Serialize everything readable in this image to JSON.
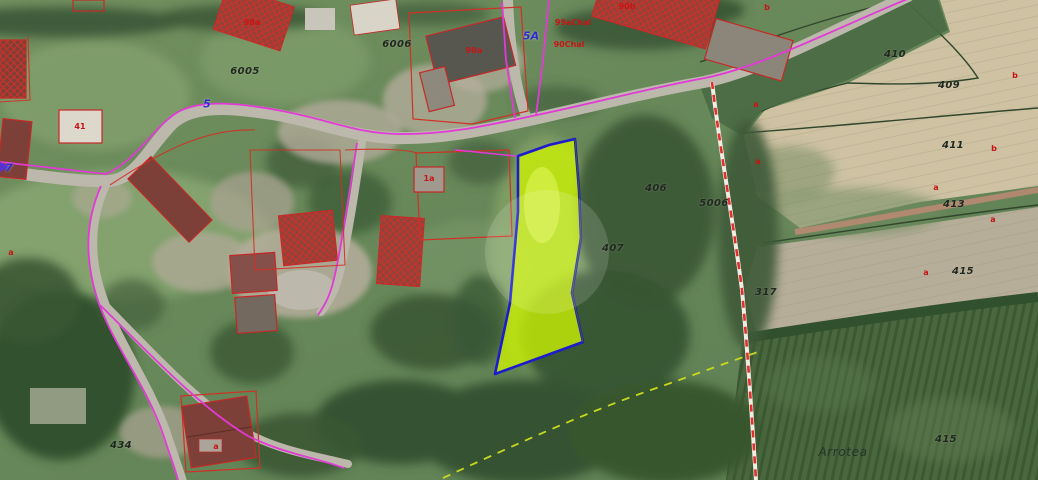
{
  "map": {
    "type": "cadastral-aerial-orthophoto",
    "highlighted_parcel": {
      "fill": "#c9f005",
      "border": "#1c1ccd"
    },
    "colors": {
      "cadastral_magenta": "#e23ad6",
      "cadastral_red": "#d13026",
      "road_label_blue": "#2b2bd0",
      "municipal_boundary_dash_red": "#e03030",
      "path_dash_yellow": "#c8d81e",
      "field_tan": "#cec2a3",
      "forest_green": "#3d5a38"
    },
    "labels": [
      {
        "text": "6005",
        "x": 245,
        "y": 72,
        "type": "parcel"
      },
      {
        "text": "6006",
        "x": 397,
        "y": 45,
        "type": "parcel"
      },
      {
        "text": "410",
        "x": 895,
        "y": 55,
        "type": "parcel"
      },
      {
        "text": "409",
        "x": 949,
        "y": 86,
        "type": "parcel"
      },
      {
        "text": "411",
        "x": 953,
        "y": 146,
        "type": "parcel"
      },
      {
        "text": "413",
        "x": 954,
        "y": 205,
        "type": "parcel"
      },
      {
        "text": "415",
        "x": 963,
        "y": 272,
        "type": "parcel"
      },
      {
        "text": "406",
        "x": 656,
        "y": 189,
        "type": "parcel"
      },
      {
        "text": "5006",
        "x": 714,
        "y": 204,
        "type": "parcel"
      },
      {
        "text": "407",
        "x": 613,
        "y": 249,
        "type": "parcel"
      },
      {
        "text": "317",
        "x": 766,
        "y": 293,
        "type": "parcel"
      },
      {
        "text": "434",
        "x": 121,
        "y": 446,
        "type": "parcel"
      },
      {
        "text": "415",
        "x": 946,
        "y": 440,
        "type": "parcel"
      },
      {
        "text": "Arrotea",
        "x": 843,
        "y": 452,
        "type": "place"
      },
      {
        "text": "5A",
        "x": 531,
        "y": 36,
        "type": "road"
      },
      {
        "text": "5",
        "x": 207,
        "y": 104,
        "type": "road"
      },
      {
        "text": "7",
        "x": 9,
        "y": 168,
        "type": "road"
      },
      {
        "text": "90a",
        "x": 474,
        "y": 51,
        "type": "red"
      },
      {
        "text": "99aChal",
        "x": 573,
        "y": 23,
        "type": "red"
      },
      {
        "text": "90Chal",
        "x": 569,
        "y": 45,
        "type": "red"
      },
      {
        "text": "90b",
        "x": 627,
        "y": 7,
        "type": "red"
      },
      {
        "text": "98a",
        "x": 252,
        "y": 23,
        "type": "red"
      },
      {
        "text": "41",
        "x": 80,
        "y": 127,
        "type": "red"
      },
      {
        "text": "1a",
        "x": 429,
        "y": 179,
        "type": "red"
      },
      {
        "text": "a",
        "x": 756,
        "y": 105,
        "type": "marker"
      },
      {
        "text": "a",
        "x": 758,
        "y": 162,
        "type": "marker"
      },
      {
        "text": "b",
        "x": 1015,
        "y": 76,
        "type": "marker"
      },
      {
        "text": "b",
        "x": 994,
        "y": 149,
        "type": "marker"
      },
      {
        "text": "a",
        "x": 936,
        "y": 188,
        "type": "marker"
      },
      {
        "text": "a",
        "x": 993,
        "y": 220,
        "type": "marker"
      },
      {
        "text": "a",
        "x": 926,
        "y": 273,
        "type": "marker"
      },
      {
        "text": "b",
        "x": 767,
        "y": 8,
        "type": "marker"
      },
      {
        "text": "a",
        "x": 11,
        "y": 253,
        "type": "marker"
      },
      {
        "text": "a",
        "x": 216,
        "y": 447,
        "type": "marker"
      }
    ]
  }
}
